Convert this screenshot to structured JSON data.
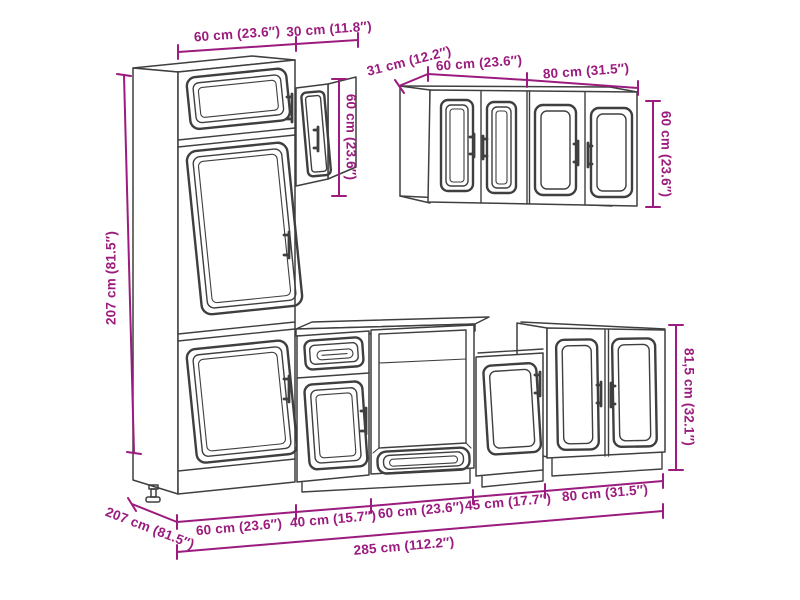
{
  "diagram": {
    "type": "furniture-dimension-diagram",
    "subject": "7-piece kitchen cabinet set line drawing with measurements",
    "colors": {
      "dimension": "#9b1b7e",
      "line": "#3f3f3f",
      "background": "#ffffff"
    },
    "labels": {
      "tall_width": "60 cm (23.6″)",
      "wall30_width": "30 cm (11.8″)",
      "tall_height": "207 cm (81.5″)",
      "wall30_height": "60 cm (23.6″)",
      "wallgroup_depth": "31 cm (12.2″)",
      "wallgroup_w60": "60 cm (23.6″)",
      "wallgroup_w80": "80 cm (31.5″)",
      "wallgroup_height": "60 cm (23.6″)",
      "base_height": "81,5 cm (32.1″)",
      "bottom_depth": "207 cm (81.5″)",
      "base_w60a": "60 cm (23.6″)",
      "base_w40": "40 cm (15.7″)",
      "base_w60b": "60 cm (23.6″)",
      "base_w45": "45 cm (17.7″)",
      "base_w80": "80 cm (31.5″)",
      "total_width": "285 cm (112.2″)"
    }
  }
}
